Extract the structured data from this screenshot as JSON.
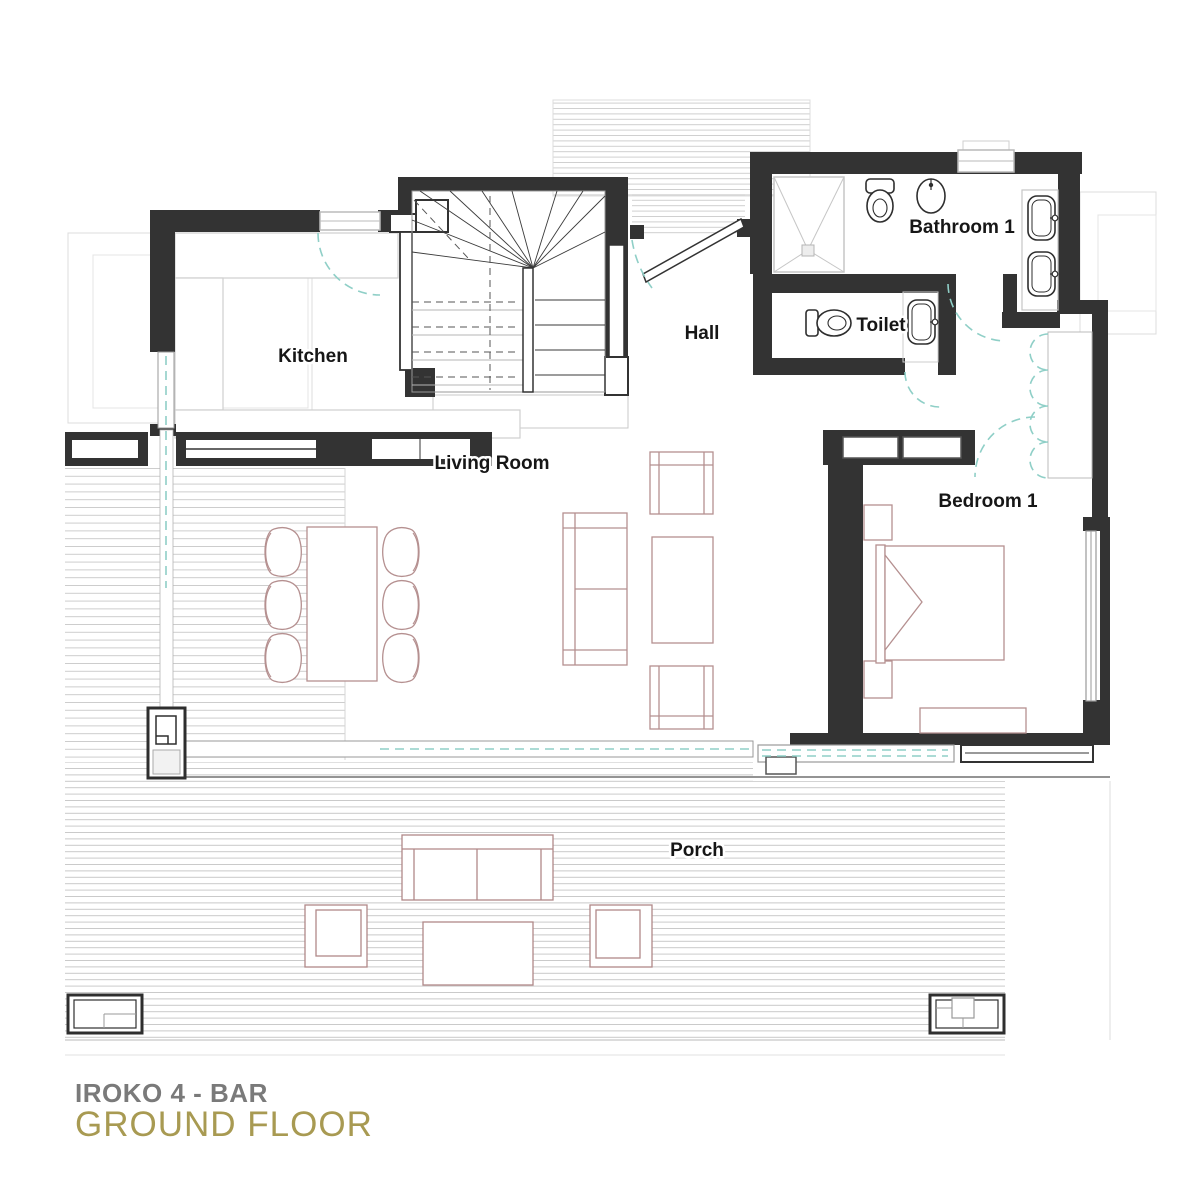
{
  "title": {
    "line1": "IROKO 4 - BAR",
    "line2": "GROUND FLOOR"
  },
  "rooms": {
    "kitchen": {
      "label": "Kitchen"
    },
    "living_room": {
      "label": "Living Room"
    },
    "hall": {
      "label": "Hall"
    },
    "toilet": {
      "label": "Toilet"
    },
    "bathroom_1": {
      "label": "Bathroom 1"
    },
    "bedroom_1": {
      "label": "Bedroom 1"
    },
    "porch": {
      "label": "Porch"
    }
  },
  "colors": {
    "wall": "#333333",
    "furniture_line": "#b59090",
    "door_swing": "#8fcfc7",
    "deck_hatch": "#cfcfcf",
    "title_primary": "#7a7a7a",
    "title_accent": "#a89a52"
  }
}
